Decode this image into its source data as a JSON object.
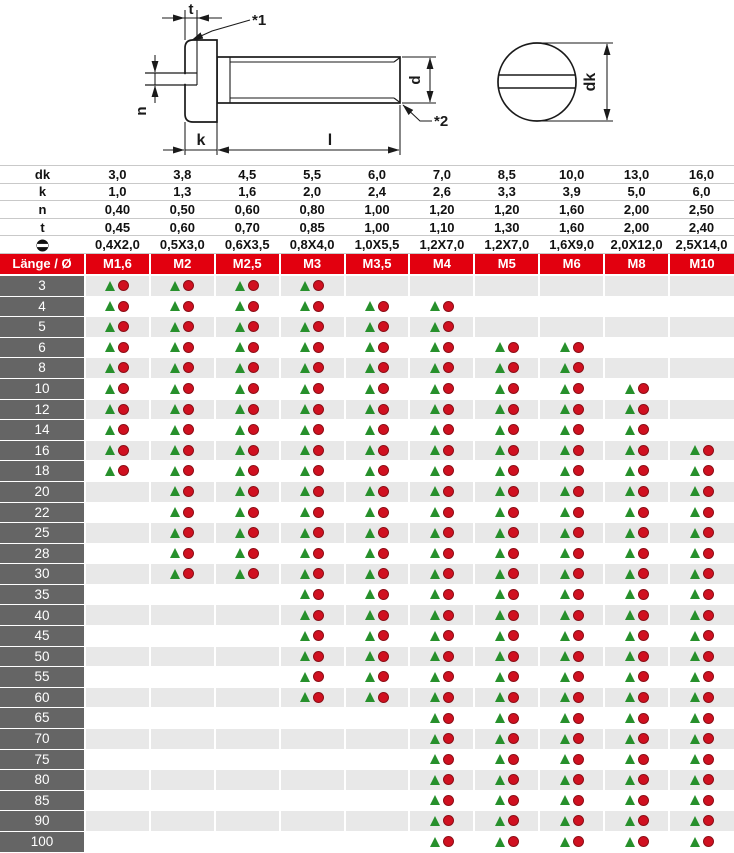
{
  "drawing": {
    "labels": {
      "t": "t",
      "n": "n",
      "k": "k",
      "l": "l",
      "d": "d",
      "dk": "dk",
      "note1": "*1",
      "note2": "*2"
    }
  },
  "spec": {
    "rows": [
      {
        "label": "dk",
        "values": [
          "3,0",
          "3,8",
          "4,5",
          "5,5",
          "6,0",
          "7,0",
          "8,5",
          "10,0",
          "13,0",
          "16,0"
        ]
      },
      {
        "label": "k",
        "values": [
          "1,0",
          "1,3",
          "1,6",
          "2,0",
          "2,4",
          "2,6",
          "3,3",
          "3,9",
          "5,0",
          "6,0"
        ]
      },
      {
        "label": "n",
        "values": [
          "0,40",
          "0,50",
          "0,60",
          "0,80",
          "1,00",
          "1,20",
          "1,20",
          "1,60",
          "2,00",
          "2,50"
        ]
      },
      {
        "label": "t",
        "values": [
          "0,45",
          "0,60",
          "0,70",
          "0,85",
          "1,00",
          "1,10",
          "1,30",
          "1,60",
          "2,00",
          "2,40"
        ]
      },
      {
        "label": "slot",
        "values": [
          "0,4X2,0",
          "0,5X3,0",
          "0,6X3,5",
          "0,8X4,0",
          "1,0X5,5",
          "1,2X7,0",
          "1,2X7,0",
          "1,6X9,0",
          "2,0X12,0",
          "2,5X14,0"
        ]
      }
    ]
  },
  "matrix": {
    "corner": "Länge / Ø",
    "columns": [
      "M1,6",
      "M2",
      "M2,5",
      "M3",
      "M3,5",
      "M4",
      "M5",
      "M6",
      "M8",
      "M10"
    ],
    "rows": [
      {
        "length": "3",
        "cells": [
          1,
          1,
          1,
          1,
          0,
          0,
          0,
          0,
          0,
          0
        ]
      },
      {
        "length": "4",
        "cells": [
          1,
          1,
          1,
          1,
          1,
          1,
          0,
          0,
          0,
          0
        ]
      },
      {
        "length": "5",
        "cells": [
          1,
          1,
          1,
          1,
          1,
          1,
          0,
          0,
          0,
          0
        ]
      },
      {
        "length": "6",
        "cells": [
          1,
          1,
          1,
          1,
          1,
          1,
          1,
          1,
          0,
          0
        ]
      },
      {
        "length": "8",
        "cells": [
          1,
          1,
          1,
          1,
          1,
          1,
          1,
          1,
          0,
          0
        ]
      },
      {
        "length": "10",
        "cells": [
          1,
          1,
          1,
          1,
          1,
          1,
          1,
          1,
          1,
          0
        ]
      },
      {
        "length": "12",
        "cells": [
          1,
          1,
          1,
          1,
          1,
          1,
          1,
          1,
          1,
          0
        ]
      },
      {
        "length": "14",
        "cells": [
          1,
          1,
          1,
          1,
          1,
          1,
          1,
          1,
          1,
          0
        ]
      },
      {
        "length": "16",
        "cells": [
          1,
          1,
          1,
          1,
          1,
          1,
          1,
          1,
          1,
          1
        ]
      },
      {
        "length": "18",
        "cells": [
          1,
          1,
          1,
          1,
          1,
          1,
          1,
          1,
          1,
          1
        ]
      },
      {
        "length": "20",
        "cells": [
          0,
          1,
          1,
          1,
          1,
          1,
          1,
          1,
          1,
          1
        ]
      },
      {
        "length": "22",
        "cells": [
          0,
          1,
          1,
          1,
          1,
          1,
          1,
          1,
          1,
          1
        ]
      },
      {
        "length": "25",
        "cells": [
          0,
          1,
          1,
          1,
          1,
          1,
          1,
          1,
          1,
          1
        ]
      },
      {
        "length": "28",
        "cells": [
          0,
          1,
          1,
          1,
          1,
          1,
          1,
          1,
          1,
          1
        ]
      },
      {
        "length": "30",
        "cells": [
          0,
          1,
          1,
          1,
          1,
          1,
          1,
          1,
          1,
          1
        ]
      },
      {
        "length": "35",
        "cells": [
          0,
          0,
          0,
          1,
          1,
          1,
          1,
          1,
          1,
          1
        ]
      },
      {
        "length": "40",
        "cells": [
          0,
          0,
          0,
          1,
          1,
          1,
          1,
          1,
          1,
          1
        ]
      },
      {
        "length": "45",
        "cells": [
          0,
          0,
          0,
          1,
          1,
          1,
          1,
          1,
          1,
          1
        ]
      },
      {
        "length": "50",
        "cells": [
          0,
          0,
          0,
          1,
          1,
          1,
          1,
          1,
          1,
          1
        ]
      },
      {
        "length": "55",
        "cells": [
          0,
          0,
          0,
          1,
          1,
          1,
          1,
          1,
          1,
          1
        ]
      },
      {
        "length": "60",
        "cells": [
          0,
          0,
          0,
          1,
          1,
          1,
          1,
          1,
          1,
          1
        ]
      },
      {
        "length": "65",
        "cells": [
          0,
          0,
          0,
          0,
          0,
          1,
          1,
          1,
          1,
          1
        ]
      },
      {
        "length": "70",
        "cells": [
          0,
          0,
          0,
          0,
          0,
          1,
          1,
          1,
          1,
          1
        ]
      },
      {
        "length": "75",
        "cells": [
          0,
          0,
          0,
          0,
          0,
          1,
          1,
          1,
          1,
          1
        ]
      },
      {
        "length": "80",
        "cells": [
          0,
          0,
          0,
          0,
          0,
          1,
          1,
          1,
          1,
          1
        ]
      },
      {
        "length": "85",
        "cells": [
          0,
          0,
          0,
          0,
          0,
          1,
          1,
          1,
          1,
          1
        ]
      },
      {
        "length": "90",
        "cells": [
          0,
          0,
          0,
          0,
          0,
          1,
          1,
          1,
          1,
          1
        ]
      },
      {
        "length": "100",
        "cells": [
          0,
          0,
          0,
          0,
          0,
          1,
          1,
          1,
          1,
          1
        ]
      }
    ]
  },
  "colors": {
    "header_red": "#e2000f",
    "length_column_gray": "#656565",
    "stripe_gray": "#e8e8e8",
    "triangle_green": "#27902c",
    "circle_red": "#d01020",
    "spec_line_gray": "#c9c9c9",
    "drawing_ink": "#1a1a1a"
  }
}
